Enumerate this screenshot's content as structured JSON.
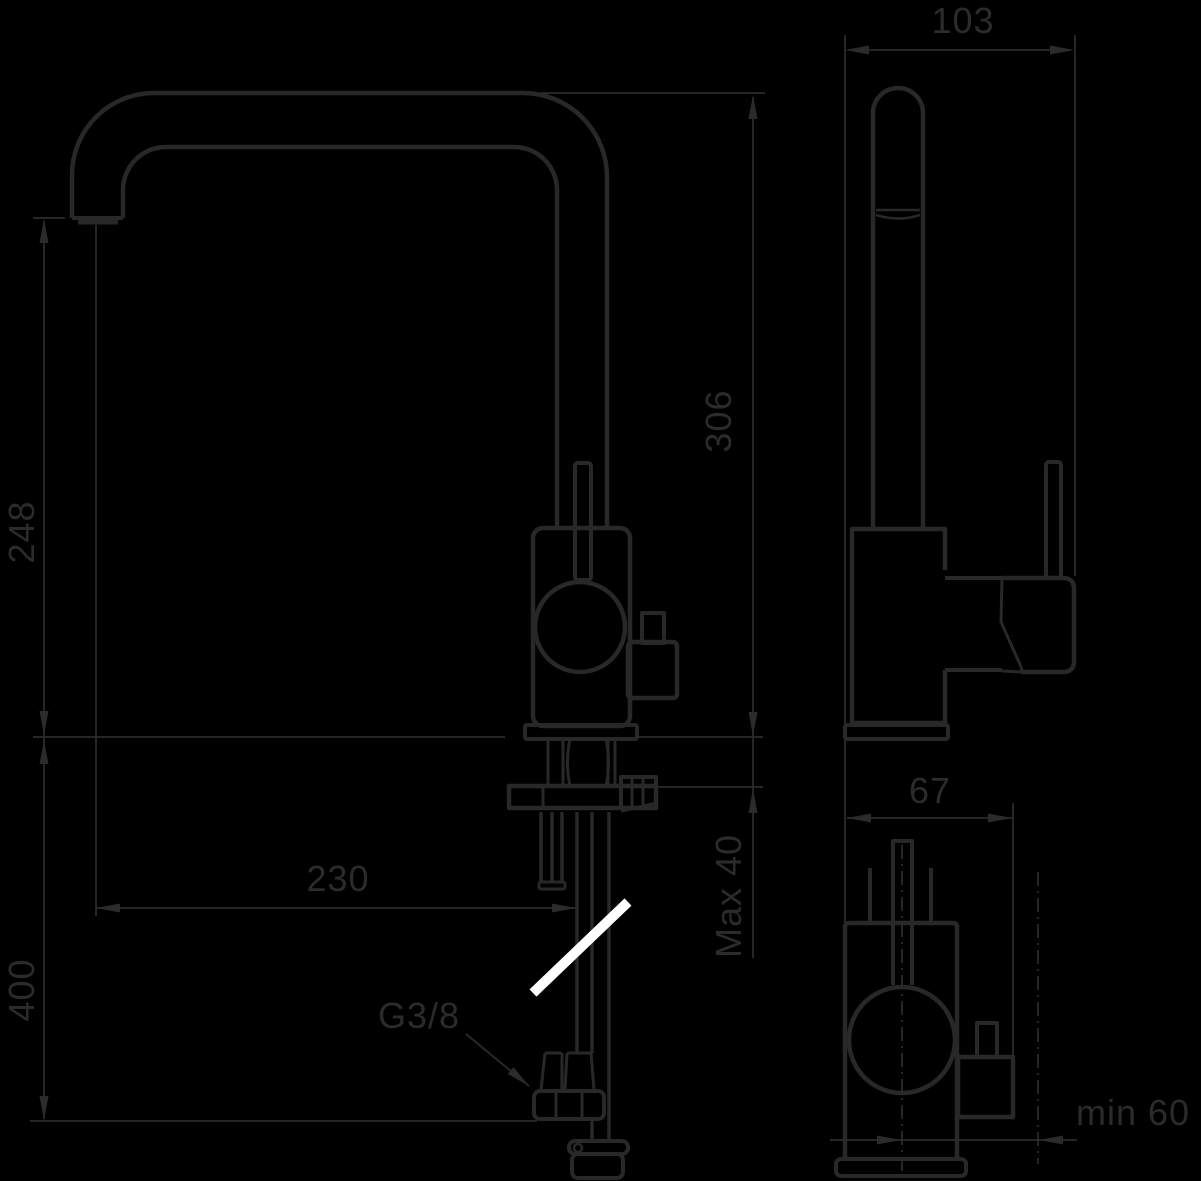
{
  "drawing": {
    "type": "technical-dimension-drawing",
    "subject": "single-lever kitchen mixer tap with dishwasher valve, three projection views",
    "colors": {
      "background": "#000000",
      "line": "#282826",
      "text": "#2b2b29",
      "highlight": "#ffffff"
    },
    "views": {
      "front": {
        "labels": {
          "outlet_height": "248",
          "total_height": "306",
          "reach": "230",
          "hose_drop": "400",
          "max_deck_thickness": "Max 40",
          "connection_thread": "G3/8"
        }
      },
      "side": {
        "labels": {
          "depth": "103"
        }
      },
      "bottom": {
        "labels": {
          "body_width": "67",
          "min_clearance": "min 60"
        }
      }
    }
  }
}
